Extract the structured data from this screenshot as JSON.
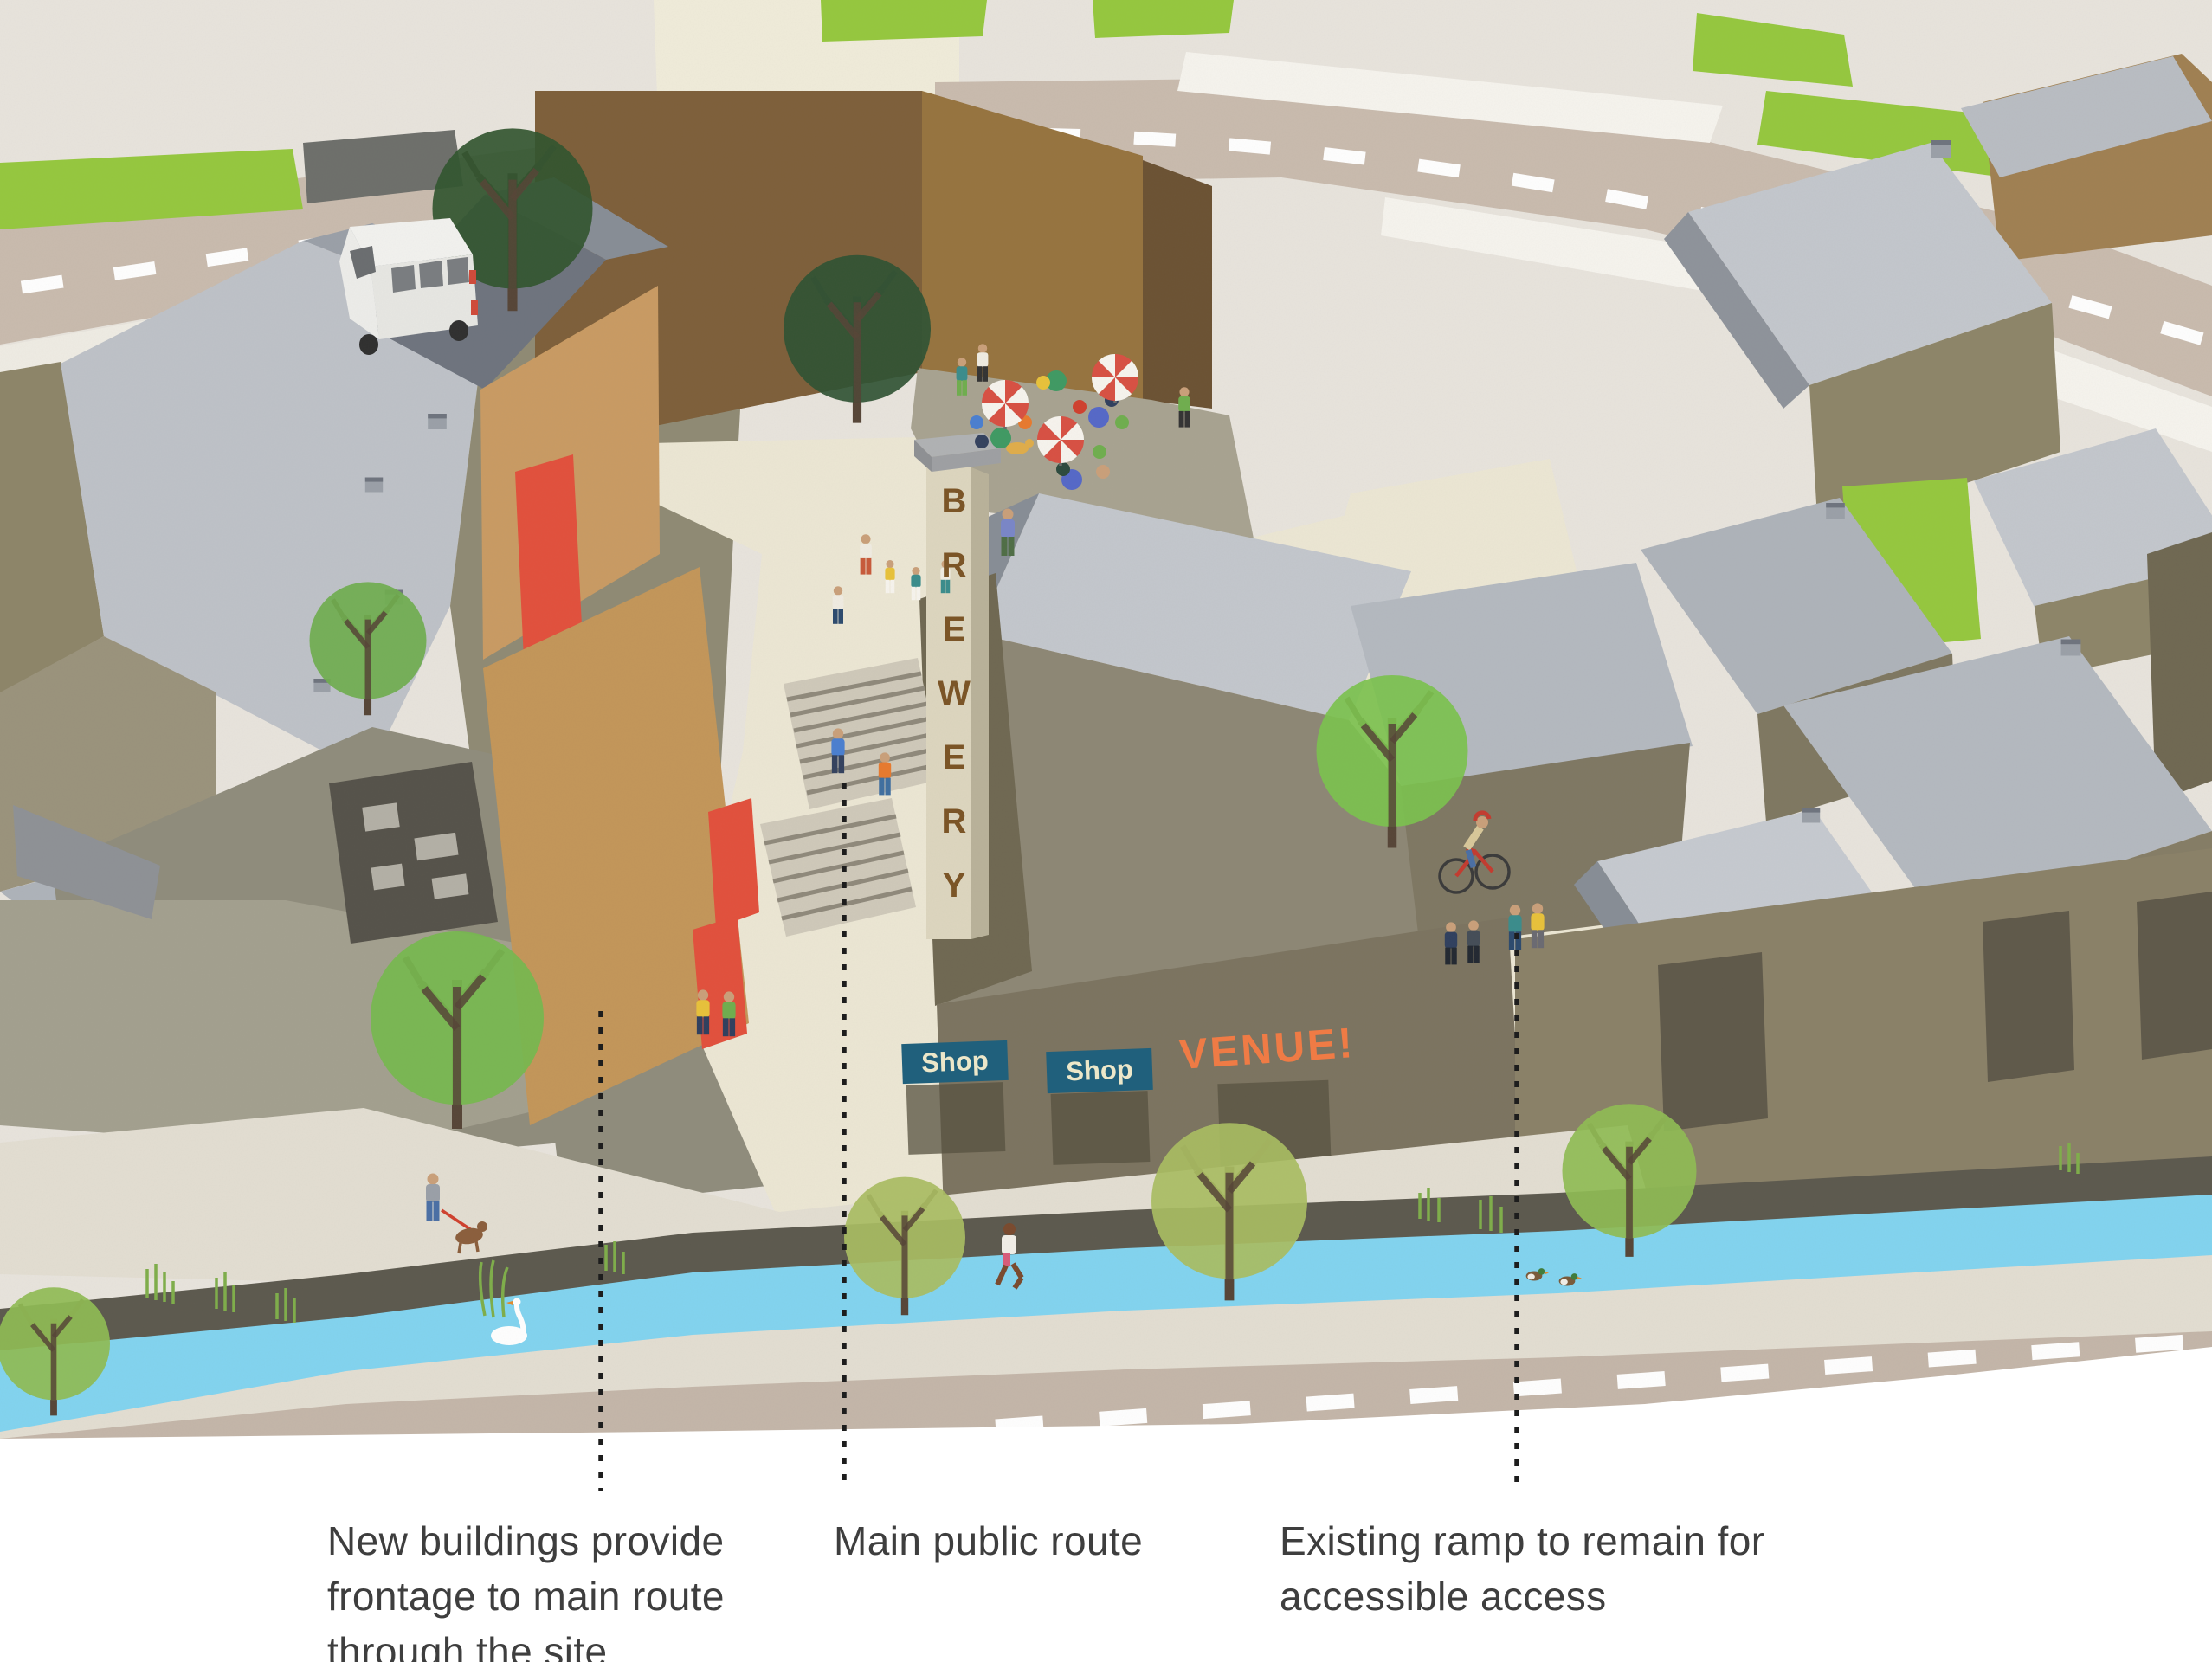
{
  "annotations": [
    {
      "id": "new-buildings",
      "lines": [
        "New buildings provide",
        "frontage to main route",
        "through the site"
      ]
    },
    {
      "id": "main-public-route",
      "lines": [
        "Main public route"
      ]
    },
    {
      "id": "existing-ramp",
      "lines": [
        "Existing ramp to remain for",
        "accessible access"
      ]
    }
  ],
  "signs": {
    "brewery": "BREWERY",
    "shop_left": "Shop",
    "shop_right": "Shop",
    "venue": "VENUE!"
  },
  "colors": {
    "paper": "#e8e4dd",
    "path_cream": "#ece7d4",
    "road": "#c9bbae",
    "road_dash": "#ffffff",
    "canal": "#82d4f0",
    "grass_verge": "#95c83e",
    "tree_bright": "#76b94e",
    "tree_olive": "#a9bd62",
    "tree_dark": "#31552f",
    "roof_light": "#c3c7cd",
    "roof_dark": "#878d96",
    "wall_olive": "#8d8569",
    "wall_brown": "#7e5f3a",
    "new_building_tan": "#c99b63",
    "banner_red": "#e2503c",
    "umbrella_red": "#d85043",
    "shop_sign_bg": "#20607c",
    "shop_sign_text": "#ece7c9",
    "venue_text": "#ef7b45",
    "brewery_text": "#7b5527",
    "annotation_text": "#3e3e3e",
    "leader_dots": "#1d1d1d"
  },
  "objects": [
    "white-van",
    "swan",
    "mallard-ducks",
    "cyclist",
    "jogger",
    "dog-walker",
    "cafe-umbrellas",
    "cafe-tables",
    "street-trees",
    "canal",
    "brewery-tower",
    "public-steps",
    "pedestrians"
  ]
}
